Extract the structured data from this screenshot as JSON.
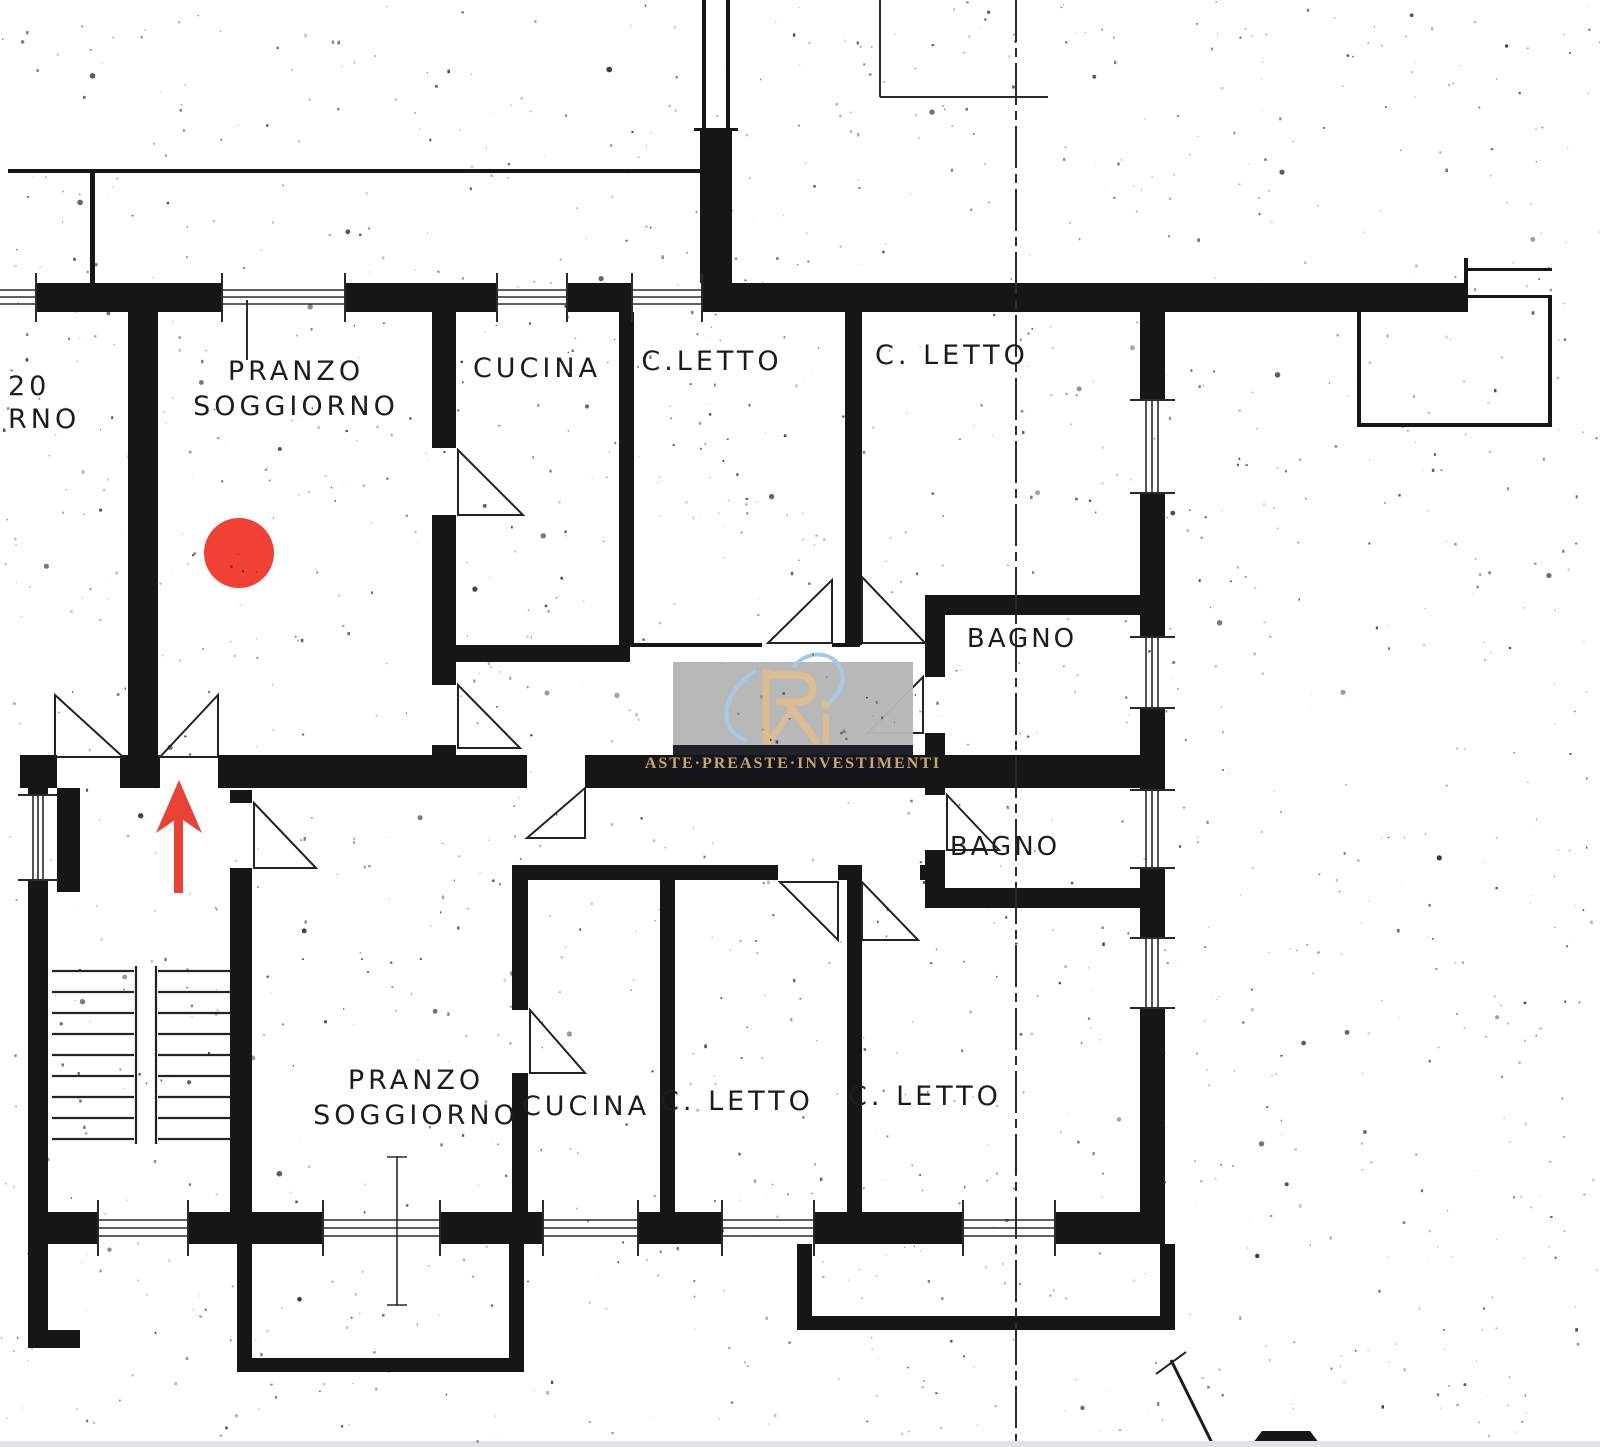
{
  "plan": {
    "kind": "apartment floor plan scan",
    "labels": {
      "cut_left_line1": "20",
      "cut_left_line2": "RNO",
      "upper": {
        "pranzo_line1": "PRANZO",
        "pranzo_line2": "SOGGIORNO",
        "cucina": "CUCINA",
        "cletto1": "C.LETTO",
        "cletto2": "C. LETTO",
        "bagno1": "BAGNO",
        "bagno2": "BAGNO"
      },
      "lower": {
        "pranzo_line1": "PRANZO",
        "pranzo_line2": "SOGGIORNO",
        "cucina": "CUCINA",
        "cletto1": "C. LETTO",
        "cletto2": "C. LETTO"
      }
    }
  },
  "markers": {
    "dot_color": "#f04134",
    "arrow_color": "#e84334"
  },
  "watermark": {
    "line": "ASTE·PREASTE·INVESTIMENTI",
    "panel": "#b5b5b5",
    "band": "#15151d",
    "gold": "#c9a66c",
    "logo_gold": "#dcbd92",
    "swoosh": "#a6c9e8"
  },
  "colors": {
    "ink": "#161616",
    "paper": "#ffffff"
  }
}
